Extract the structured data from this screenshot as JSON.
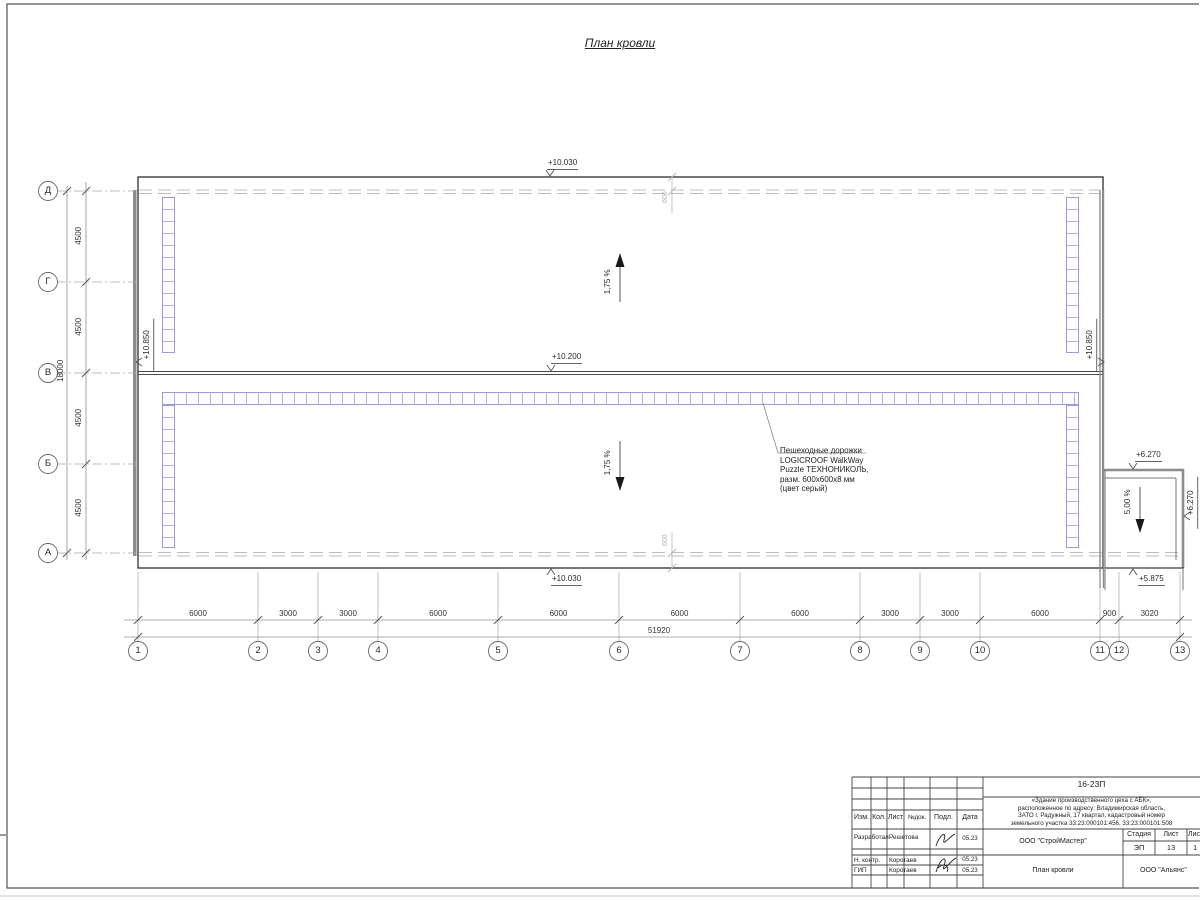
{
  "page": {
    "title": "План кровли"
  },
  "colors": {
    "walkway": "#9b9bd8",
    "wall": "#8c8c8c",
    "roof_edge_dash": "#bcbcbc",
    "line": "#3c3c3c"
  },
  "axes": {
    "rows": [
      "Д",
      "Г",
      "В",
      "Б",
      "А"
    ],
    "cols": [
      "1",
      "2",
      "3",
      "4",
      "5",
      "6",
      "7",
      "8",
      "9",
      "10",
      "11",
      "12",
      "13"
    ],
    "row_dims": [
      "4500",
      "4500",
      "4500",
      "4500"
    ],
    "row_total": "18000",
    "col_dims": [
      "6000",
      "3000",
      "3000",
      "6000",
      "6000",
      "6000",
      "6000",
      "3000",
      "3000",
      "6000",
      "900",
      "3020"
    ],
    "col_total": "51920"
  },
  "parapet_dims": {
    "top": "600",
    "bottom": "600"
  },
  "elevations": {
    "top_main": "+10.030",
    "ridge": "+10.200",
    "bottom_main": "+10.030",
    "left_wall": "+10.850",
    "right_wall": "+10.850",
    "annex_top": "+6.270",
    "annex_right": "+6.270",
    "annex_bottom": "+5.875"
  },
  "slopes": {
    "upper": "1,75 %",
    "lower": "1,75 %",
    "annex": "5,00 %"
  },
  "walkway_note": {
    "line1": "Пешеходные дорожки",
    "line2": "LOGICROOF WalkWay",
    "line3": "Puzzle ТЕХНОНИКОЛЬ,",
    "line4": "разм. 600х600х8 мм",
    "line5": "(цвет серый)"
  },
  "titleblock": {
    "doc_number": "16-23П",
    "project": {
      "line1": "«Здание производственного цеха с АБК»,",
      "line2": "расположенное по адресу: Владимирская область,",
      "line3": "ЗАТО г. Радужный, 17 квартал, кадастровый номер",
      "line4": "земельного участка 33:23:000101:456, 33:23:000101:508"
    },
    "headers": {
      "izm": "Изм.",
      "kol": "Кол.",
      "list": "Лист",
      "ndok": "№док.",
      "podp": "Подл.",
      "date": "Дата"
    },
    "rows": [
      {
        "role": "Разработал",
        "name": "Решетова",
        "date": "05.23"
      },
      {
        "role": "Н. контр.",
        "name": "Коротаев",
        "date": "05.23"
      },
      {
        "role": "ГИП",
        "name": "Коротаев",
        "date": "05.23"
      }
    ],
    "org": "ООО \"СтройМастер\"",
    "stage_label": "Стадия",
    "sheet_label": "Лист",
    "sheets_label": "Лис",
    "stage": "ЭП",
    "sheet": "13",
    "sheets": "1",
    "drawing_name": "План кровли",
    "client": "ООО \"Альянс\""
  }
}
